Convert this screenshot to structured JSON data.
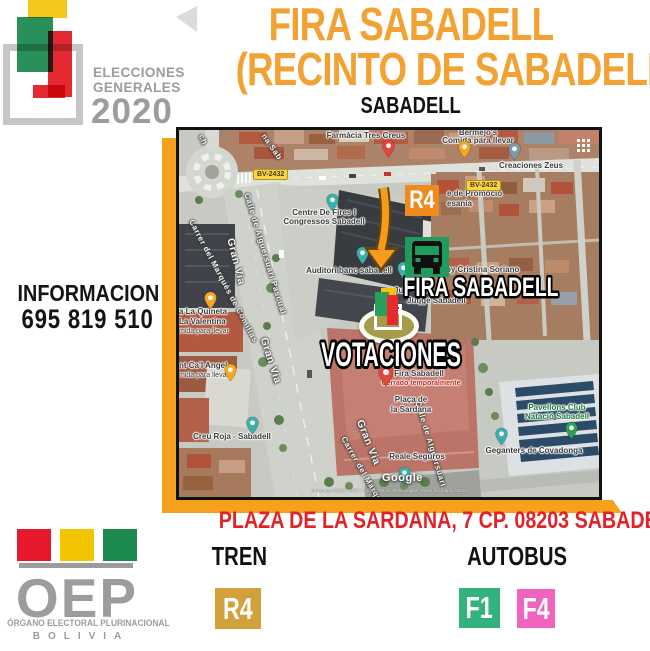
{
  "header": {
    "elections_logo": {
      "line1": "ELECCIONES",
      "line2": "GENERALES",
      "year": "2020"
    },
    "title_line1": "FIRA SABADELL",
    "title_line2": "(RECINTO DE SABADELL)",
    "subtitle": "SABADELL"
  },
  "info_block": {
    "label": "INFORMACION",
    "phone": "695 819 510"
  },
  "map": {
    "road_badge_left": "BV-2432",
    "road_badge_right": "BV-2432",
    "train_badge": "R4",
    "fira_label": "FIRA SABADELL",
    "votaciones_label": "VOTACIONES",
    "google_watermark": "Google",
    "attribution": "Imágenes ©2020 CNES / Airbus, Maxar Technologies, Datos del mapa ©2020",
    "pois": {
      "farmacia": "Farmàcia Tres Creus",
      "bermejos_1": "Bermejo's",
      "bermejos_2": "Comida para llevar",
      "creaciones": "Creaciones Zeus",
      "promocio_1": "e de Promoció",
      "promocio_2": "esania",
      "centre_1": "Centre De Fires I",
      "centre_2": "Congressos Sabadell",
      "auditori": "Auditori banc sabadell",
      "cristina": "by Cristina Soriano",
      "jun": "Jun",
      "jutjats": "Jutjge Sabadell",
      "fira_place": "Fira Sabadell",
      "fira_status": "Cerrado temporalmente",
      "placa_1": "Plaça de",
      "placa_2": "la Sardana",
      "creu_roja": "Creu Roja - Sabadell",
      "reale": "Reale Seguros",
      "pavellons_1": "Pavellons Club",
      "pavellons_2": "Natació Sabadell",
      "geganters": "Geganters de Covadonga",
      "quineta_1": "a La Quineta",
      "quineta_2": "La Valentina",
      "quineta_3": "mida para llevar",
      "angel_1": "nt Ca'l Angel",
      "angel_2": "mida para llevar"
    },
    "streets": {
      "gran_via_1": "Gran Via",
      "gran_via_2": "Gran Via",
      "gran_via_3": "Gran Via",
      "alguersuari_1": "Calle de Alguersuari Pascual",
      "alguersuari_2": "Calle de Alguersuari",
      "comillas_1": "Carrer del Marquès de Comillas",
      "comillas_2": "Carrer del Marquès",
      "frag_ch": "ch",
      "frag_na_sab": "na Sab"
    }
  },
  "footer": {
    "address": "PLAZA DE LA SARDANA, 7 CP. 08203 SABADELL",
    "tren_label": "TREN",
    "tren_badge": "R4",
    "autobus_label": "AUTOBUS",
    "bus_badge_1": "F1",
    "bus_badge_2": "F4"
  },
  "oep_logo": {
    "acronym": "OEP",
    "line1": "ÓRGANO ELECTORAL PLURINACIONAL",
    "line2": "BOLIVIA"
  },
  "colors": {
    "accent_orange": "#F2A233",
    "frame_orange": "#F5A11C",
    "alert_red": "#E12228",
    "train_gold": "#D3A13B",
    "map_r4_orange": "#F08A1F",
    "bus_green": "#33B27E",
    "bus_pink": "#F063BE",
    "bus_icon_green": "#1E9C5E",
    "logo_gray": "#9C9C9C"
  }
}
